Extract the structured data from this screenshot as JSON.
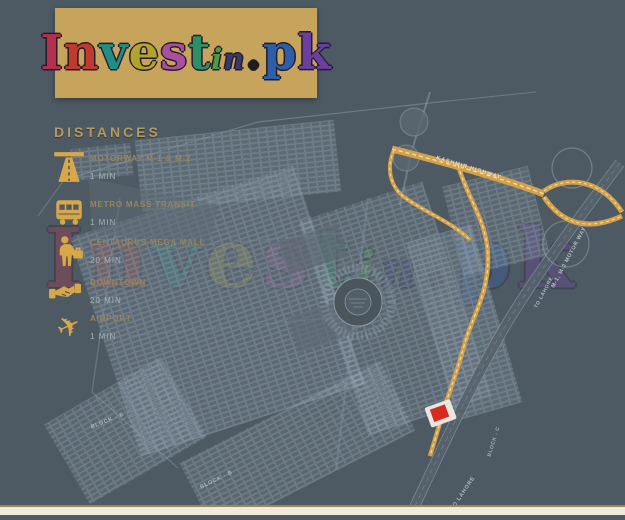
{
  "logo": {
    "letters": [
      "I",
      "n",
      "v",
      "e",
      "s",
      "t",
      "i",
      "n",
      ".",
      "p",
      "k"
    ]
  },
  "distances": {
    "title": "DISTANCES",
    "items": [
      {
        "icon": "motorway-icon",
        "label": "MOTORWAY M-1 & M-2",
        "value": "1 MIN"
      },
      {
        "icon": "bus-icon",
        "label": "METRO MASS TRANSIT",
        "value": "1 MIN"
      },
      {
        "icon": "traveler-icon",
        "label": "CENTAURUS MEGA MALL",
        "value": "20 MIN"
      },
      {
        "icon": "handshake-icon",
        "label": "DOWNTOWN",
        "value": "20 MIN"
      },
      {
        "icon": "airplane-icon",
        "label": "AIRPORT",
        "value": "1 MIN"
      }
    ]
  },
  "map": {
    "labels": {
      "kashmir_highway": "KASHMIR HIGHWAY",
      "motorway": "M-1, M-2 MOTOR WAY",
      "to_lahore_upper": "TO LAHORE",
      "to_lahore_lower": "TO LAHORE",
      "block_e": "BLOCK - E",
      "block_b": "BLOCK - B",
      "block_c": "BLOCK - C"
    }
  },
  "colors": {
    "background": "#4e5a63",
    "logo_panel_gold": "#c7a45c",
    "icon_gold": "#d8a848",
    "route_gold": "#d4a14b",
    "heading_gold": "#b49a62",
    "label_gold": "#97855c",
    "value_gray": "#a9b0b6",
    "marker_red": "#d62b1f"
  }
}
